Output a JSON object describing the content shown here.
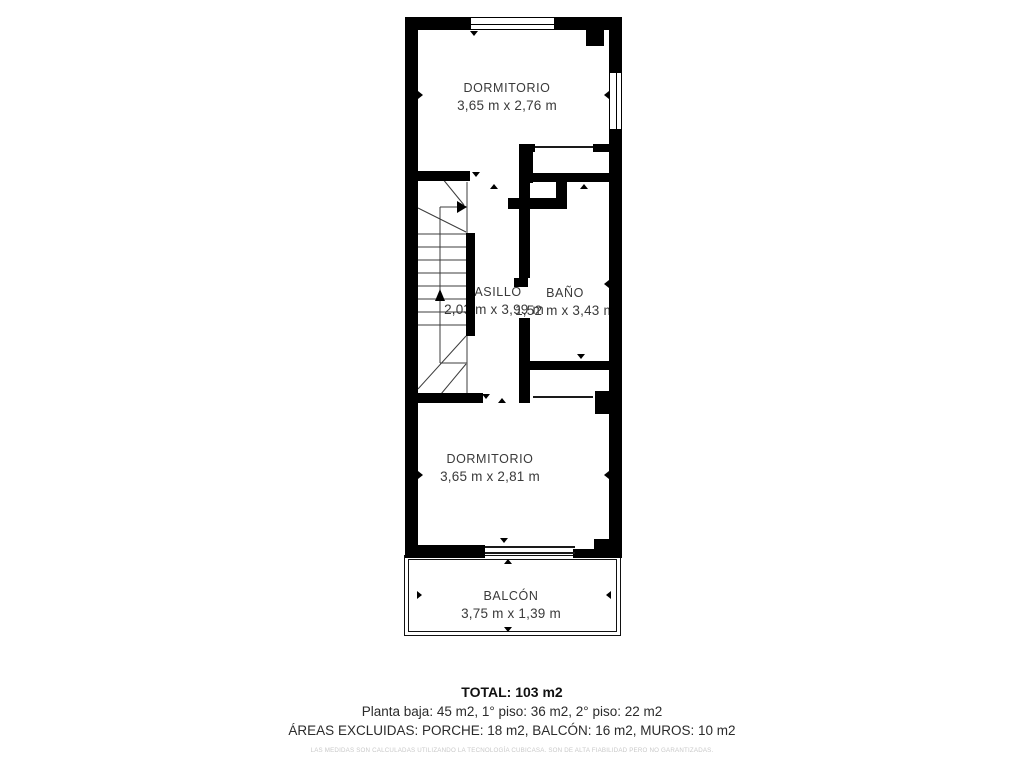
{
  "rooms": [
    {
      "name": "DORMITORIO",
      "dims": "3,65 m x 2,76 m"
    },
    {
      "name": "PASILLO",
      "dims": "2,03 m x 3,99 m"
    },
    {
      "name": "BAÑO",
      "dims": "1,52 m x 3,43 m"
    },
    {
      "name": "DORMITORIO",
      "dims": "3,65 m x 2,81 m"
    },
    {
      "name": "BALCÓN",
      "dims": "3,75 m x 1,39 m"
    }
  ],
  "footer": {
    "total": "TOTAL: 103 m2",
    "floors": "Planta baja: 45 m2, 1° piso: 36 m2, 2° piso: 22 m2",
    "excluded": "ÁREAS EXCLUIDAS: PORCHE: 18 m2, BALCÓN: 16 m2, MUROS: 10 m2",
    "disclaimer": "LAS MEDIDAS SON CALCULADAS UTILIZANDO LA TECNOLOGÍA CUBICASA. SON DE ALTA FIABILIDAD PERO NO GARANTIZADAS."
  },
  "colors": {
    "wall": "#000000",
    "room_text": "#3a3a3a",
    "footer_text": "#2b2b2b",
    "disclaimer_text": "#c9c9c9"
  }
}
